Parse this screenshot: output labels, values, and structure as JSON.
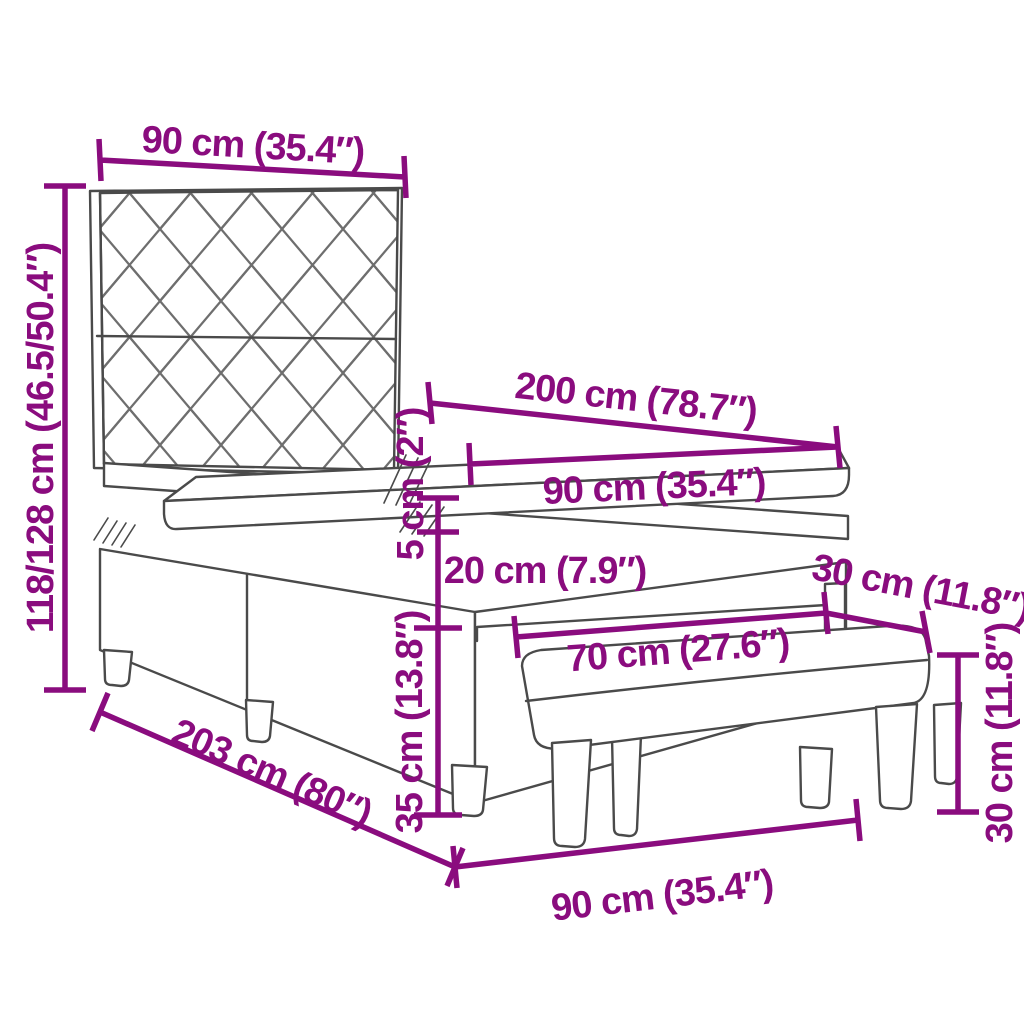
{
  "colors": {
    "dimension": "#8A0C7E",
    "outline": "#4A4A4A",
    "pattern": "#6E6E6E"
  },
  "labels": {
    "headboard_width": "90 cm (35.4″)",
    "overall_height": "118/128 cm (46.5/50.4″)",
    "mattress_length": "200 cm (78.7″)",
    "mattress_width": "90 cm (35.4″)",
    "mattress_height": "5 cm (2″)",
    "box_spring_height": "20 cm (7.9″)",
    "base_height": "35 cm (13.8″)",
    "bench_length": "70 cm (27.6″)",
    "bench_depth": "30 cm (11.8″)",
    "bench_height": "30 cm (11.8″)",
    "bed_length": "203 cm (80″)",
    "bench_overall_width": "90 cm (35.4″)"
  }
}
